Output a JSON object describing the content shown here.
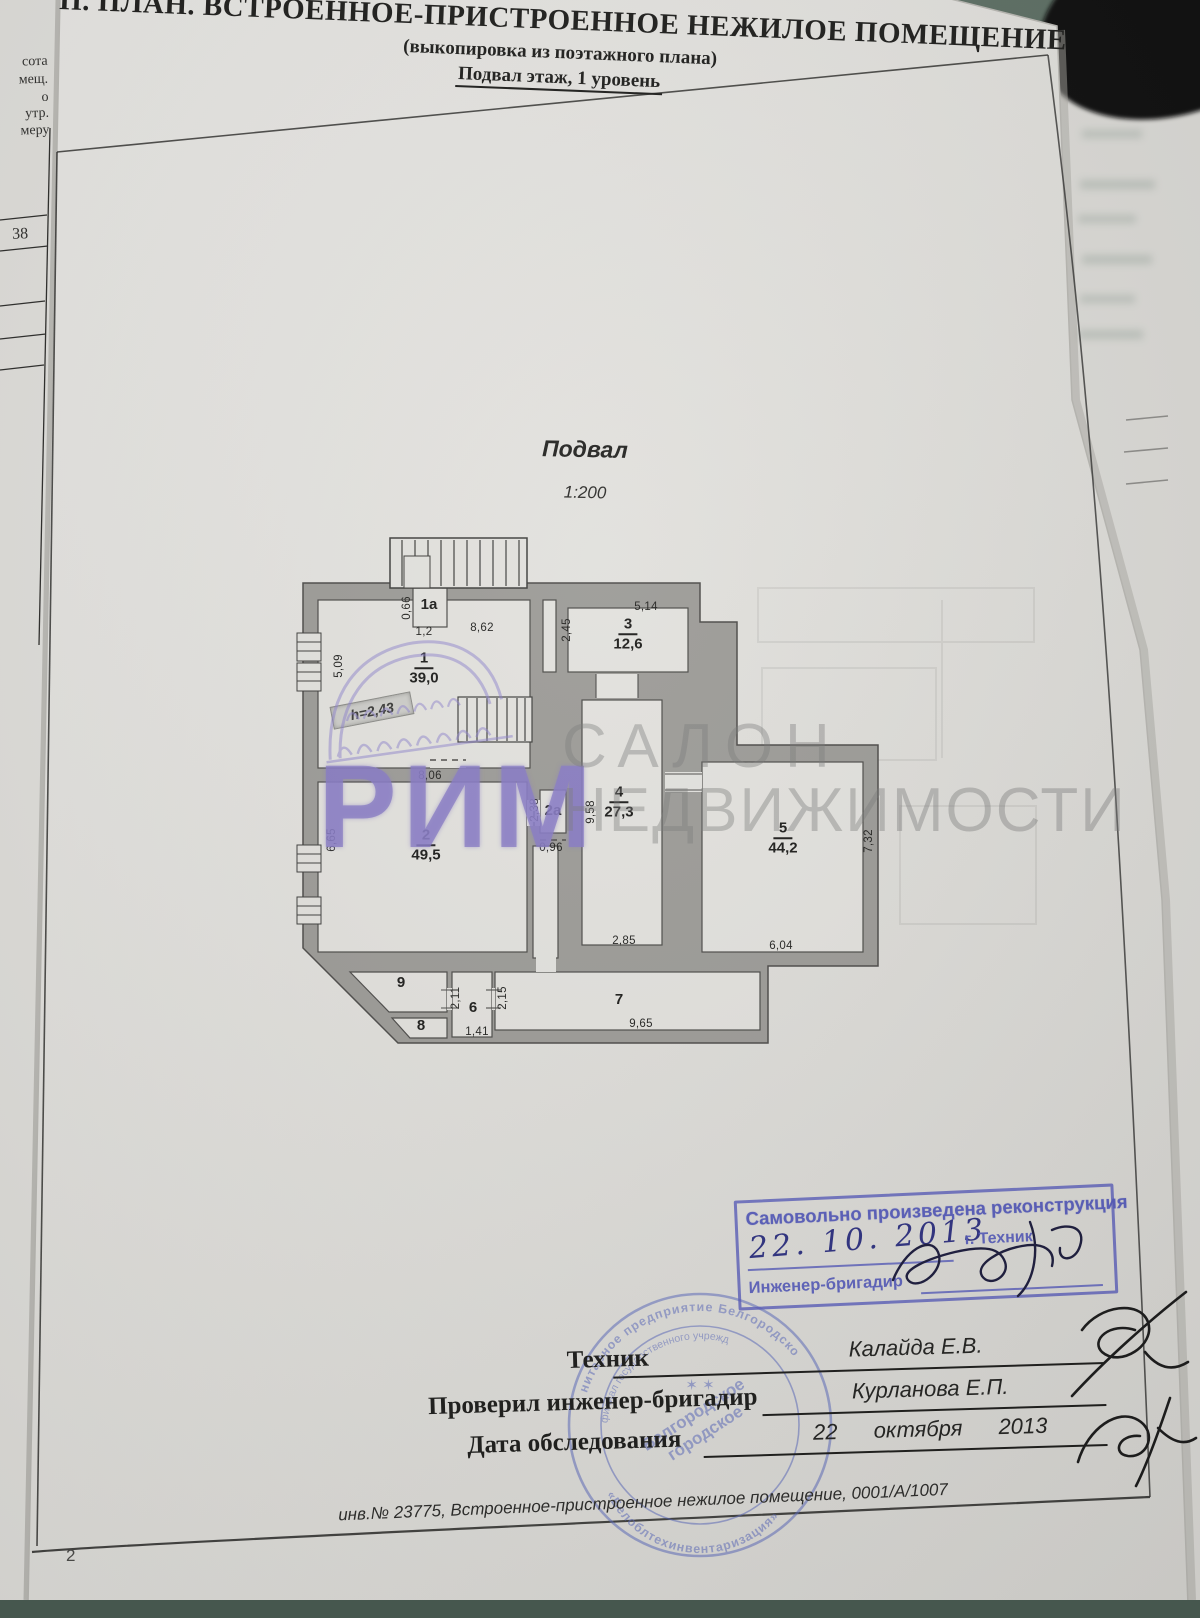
{
  "header": {
    "title": "П. ПЛАН. ВСТРОЕННОЕ-ПРИСТРОЕННОЕ НЕЖИЛОЕ ПОМЕЩЕНИЕ",
    "subtitle": "(выкопировка из поэтажного плана)",
    "floor_line": "Подвал этаж, 1 уровень"
  },
  "plan": {
    "caption": "Подвал",
    "scale": "1:200",
    "height_note": "h=2,43",
    "room_labels": [
      {
        "num": "1",
        "area": "39,0",
        "x": 424,
        "y": 668
      },
      {
        "num": "1а",
        "x": 429,
        "y": 605
      },
      {
        "num": "2",
        "area": "49,5",
        "x": 426,
        "y": 845
      },
      {
        "num": "2а",
        "x": 553,
        "y": 811
      },
      {
        "num": "3",
        "area": "12,6",
        "x": 628,
        "y": 634
      },
      {
        "num": "4",
        "area": "27,3",
        "x": 619,
        "y": 802
      },
      {
        "num": "5",
        "area": "44,2",
        "x": 783,
        "y": 838
      },
      {
        "num": "6",
        "x": 473,
        "y": 1008
      },
      {
        "num": "7",
        "x": 619,
        "y": 1000
      },
      {
        "num": "8",
        "x": 421,
        "y": 1026
      },
      {
        "num": "9",
        "x": 401,
        "y": 983
      }
    ],
    "dim_labels": [
      {
        "t": "0,66",
        "x": 407,
        "y": 608,
        "r": -90
      },
      {
        "t": "1,2",
        "x": 424,
        "y": 632,
        "r": 0
      },
      {
        "t": "8,62",
        "x": 482,
        "y": 628,
        "r": 0
      },
      {
        "t": "5,09",
        "x": 339,
        "y": 666,
        "r": -90
      },
      {
        "t": "5,14",
        "x": 646,
        "y": 607,
        "r": 0
      },
      {
        "t": "2,45",
        "x": 567,
        "y": 630,
        "r": -90
      },
      {
        "t": "8,06",
        "x": 430,
        "y": 776,
        "r": 0
      },
      {
        "t": "6,65",
        "x": 332,
        "y": 840,
        "r": -90
      },
      {
        "t": "2,38",
        "x": 535,
        "y": 810,
        "r": -90
      },
      {
        "t": "0,96",
        "x": 551,
        "y": 848,
        "r": 0
      },
      {
        "t": "9,58",
        "x": 591,
        "y": 812,
        "r": -90
      },
      {
        "t": "2,85",
        "x": 624,
        "y": 941,
        "r": 0
      },
      {
        "t": "7,32",
        "x": 869,
        "y": 841,
        "r": -90
      },
      {
        "t": "6,04",
        "x": 781,
        "y": 946,
        "r": 0
      },
      {
        "t": "2,11",
        "x": 456,
        "y": 998,
        "r": -90
      },
      {
        "t": "2,15",
        "x": 503,
        "y": 998,
        "r": -90
      },
      {
        "t": "1,41",
        "x": 477,
        "y": 1032,
        "r": 0
      },
      {
        "t": "9,65",
        "x": 641,
        "y": 1024,
        "r": 0
      }
    ]
  },
  "watermarks": {
    "agency_name": "РИМ",
    "salon_line1": "САЛОН",
    "salon_line2": "НЕДВИЖИМОСТИ"
  },
  "stamp_reconstruction": {
    "title": "Самовольно произведена реконструкция",
    "handwritten_date": "22. 10. 2013",
    "city_label": "г. Техник",
    "role_label": "Инженер-бригадир"
  },
  "seal": {
    "outer_top": "нитарное предприятие Белгородско",
    "outer_bottom": "«Белоблтехинвентаризация»",
    "inner_arc": "филиал государственного учрежд",
    "center_line1": "Белгородское",
    "center_line2": "городское",
    "stars": "✶  ✶"
  },
  "signature_block": {
    "rows": [
      {
        "label": "Техник",
        "value": "Калайда Е.В."
      },
      {
        "label": "Проверил инженер-бригадир",
        "value": "Курланова Е.П."
      },
      {
        "label": "Дата обследования",
        "value": "22 октября 2013"
      }
    ]
  },
  "footer": {
    "line": "инв.№ 23775, Встроенное-пристроенное нежилое помещение, 0001/А/1007",
    "page_number": "2"
  },
  "left_page_fragment": {
    "texts": [
      "сота",
      "мещ.",
      "о",
      "утр.",
      "меру"
    ],
    "value": "38"
  }
}
